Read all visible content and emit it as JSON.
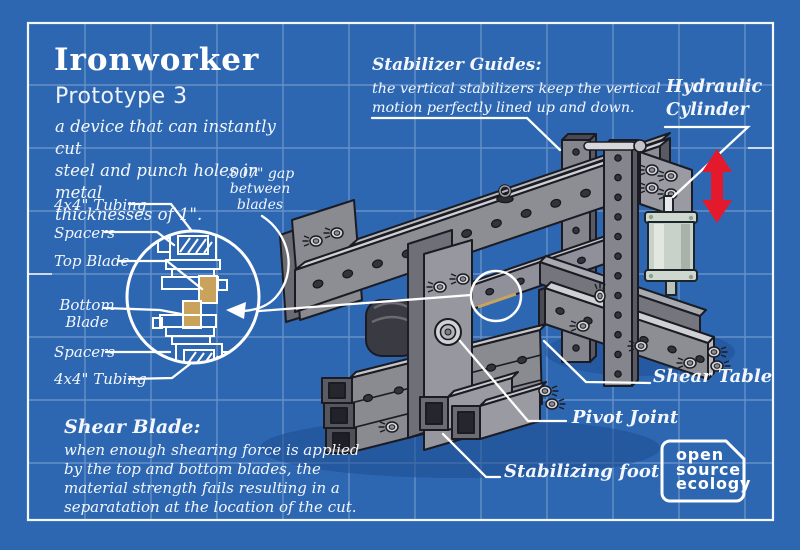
{
  "header": {
    "title": "Ironworker",
    "subtitle": "Prototype 3",
    "description_lines": [
      "a device that can instantly cut",
      "steel and punch holes in metal",
      "thicknesses of 1\"."
    ]
  },
  "detail_view": {
    "gap_lines": [
      ".007\" gap",
      "between",
      "blades"
    ],
    "labels": [
      "4x4\" Tubing",
      "Spacers",
      "Top Blade",
      "Bottom Blade",
      "Spacers",
      "4x4\" Tubing"
    ]
  },
  "callouts": {
    "stabilizer_title": "Stabilizer Guides:",
    "stabilizer_lines": [
      "the vertical stabilizers keep the vertical",
      "motion perfectly lined up and down."
    ],
    "hydraulic_lines": [
      "Hydraulic",
      "Cylinder"
    ],
    "shear_table": "Shear Table",
    "pivot_joint": "Pivot Joint",
    "stabilizing_foot": "Stabilizing foot",
    "shear_blade_title": "Shear Blade:",
    "shear_blade_lines": [
      "when enough shearing force is applied",
      "by the top and bottom blades, the",
      "material strength fails resulting in a",
      "separatation at the location of the cut."
    ]
  },
  "logo_lines": [
    "open",
    "source",
    "ecology"
  ],
  "colors": {
    "blueprint_blue": "#2d67b2",
    "line_white": "#ffffff",
    "accent_red": "#e4192b",
    "blade_tan": "#c9a35b",
    "steel_gray": "#8d8d94",
    "steel_dark": "#55555c",
    "steel_light": "#cfcfd4"
  }
}
